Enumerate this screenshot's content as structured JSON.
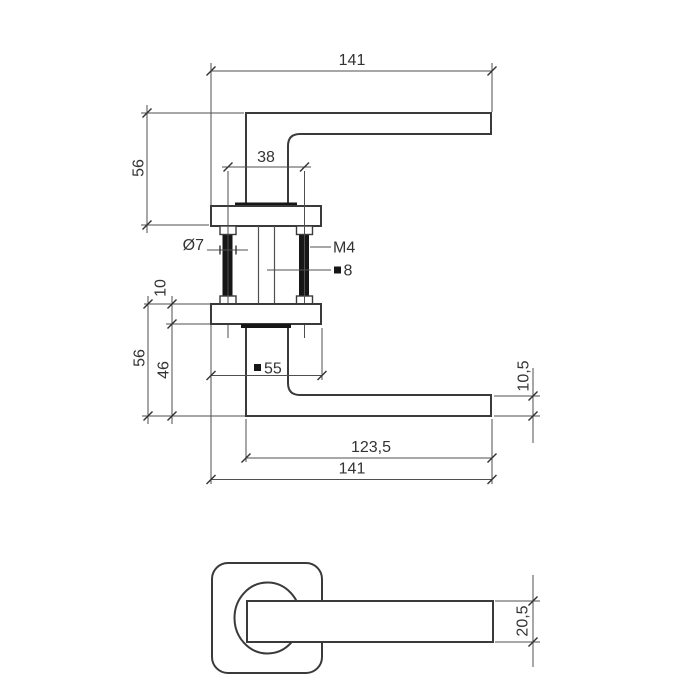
{
  "drawing": {
    "type": "technical-dimension-drawing",
    "subject": "door lever handle on square rosette, side assembly view and front view",
    "colors": {
      "background": "#ffffff",
      "object_line": "#3a3a3a",
      "dimension_line": "#4f4f4f",
      "text": "#333333",
      "solid_fill": "#161616"
    },
    "icons": {
      "diameter_symbol": "Ø",
      "square_section_symbol": "■"
    },
    "side_view": {
      "dims": {
        "overall_length_top": "141",
        "height_top": "56",
        "bolt_spacing": "38",
        "bolt_hole_diameter": "Ø7",
        "bolt_thread": "M4",
        "spindle_size": "8",
        "rosette_thickness": "10",
        "height_bottom": "56",
        "neck_height": "46",
        "rosette_size": "55",
        "grip_length": "123,5",
        "overall_length_bottom": "141",
        "lever_thickness": "10,5"
      }
    },
    "front_view": {
      "dims": {
        "lever_width": "20,5"
      }
    }
  }
}
